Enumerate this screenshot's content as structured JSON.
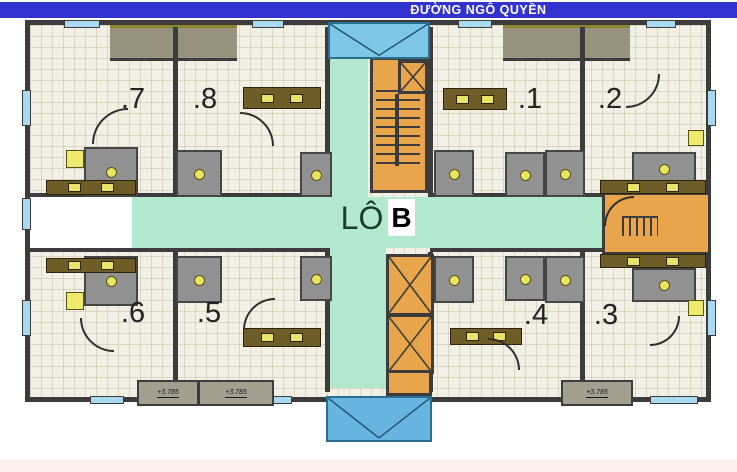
{
  "street_banner": {
    "label": "ĐƯỜNG NGÔ QUYỀN"
  },
  "block": {
    "prefix": "LÔ",
    "letter": "B"
  },
  "units": [
    {
      "id": "7",
      "label": ".7"
    },
    {
      "id": "8",
      "label": ".8"
    },
    {
      "id": "1",
      "label": ".1"
    },
    {
      "id": "2",
      "label": ".2"
    },
    {
      "id": "6",
      "label": ".6"
    },
    {
      "id": "5",
      "label": ".5"
    },
    {
      "id": "4",
      "label": ".4"
    },
    {
      "id": "3",
      "label": ".3"
    }
  ],
  "level_marks": [
    {
      "label": "+3.785"
    },
    {
      "label": "+3.785"
    },
    {
      "label": "+3.785"
    }
  ],
  "colors": {
    "street_banner": "#3232cf",
    "corridor": "#b2e8cd",
    "stair_core": "#e9a54b",
    "canopy": "#74c0e6",
    "walls": "#3c3c3c",
    "floor": "#f2efe4"
  }
}
